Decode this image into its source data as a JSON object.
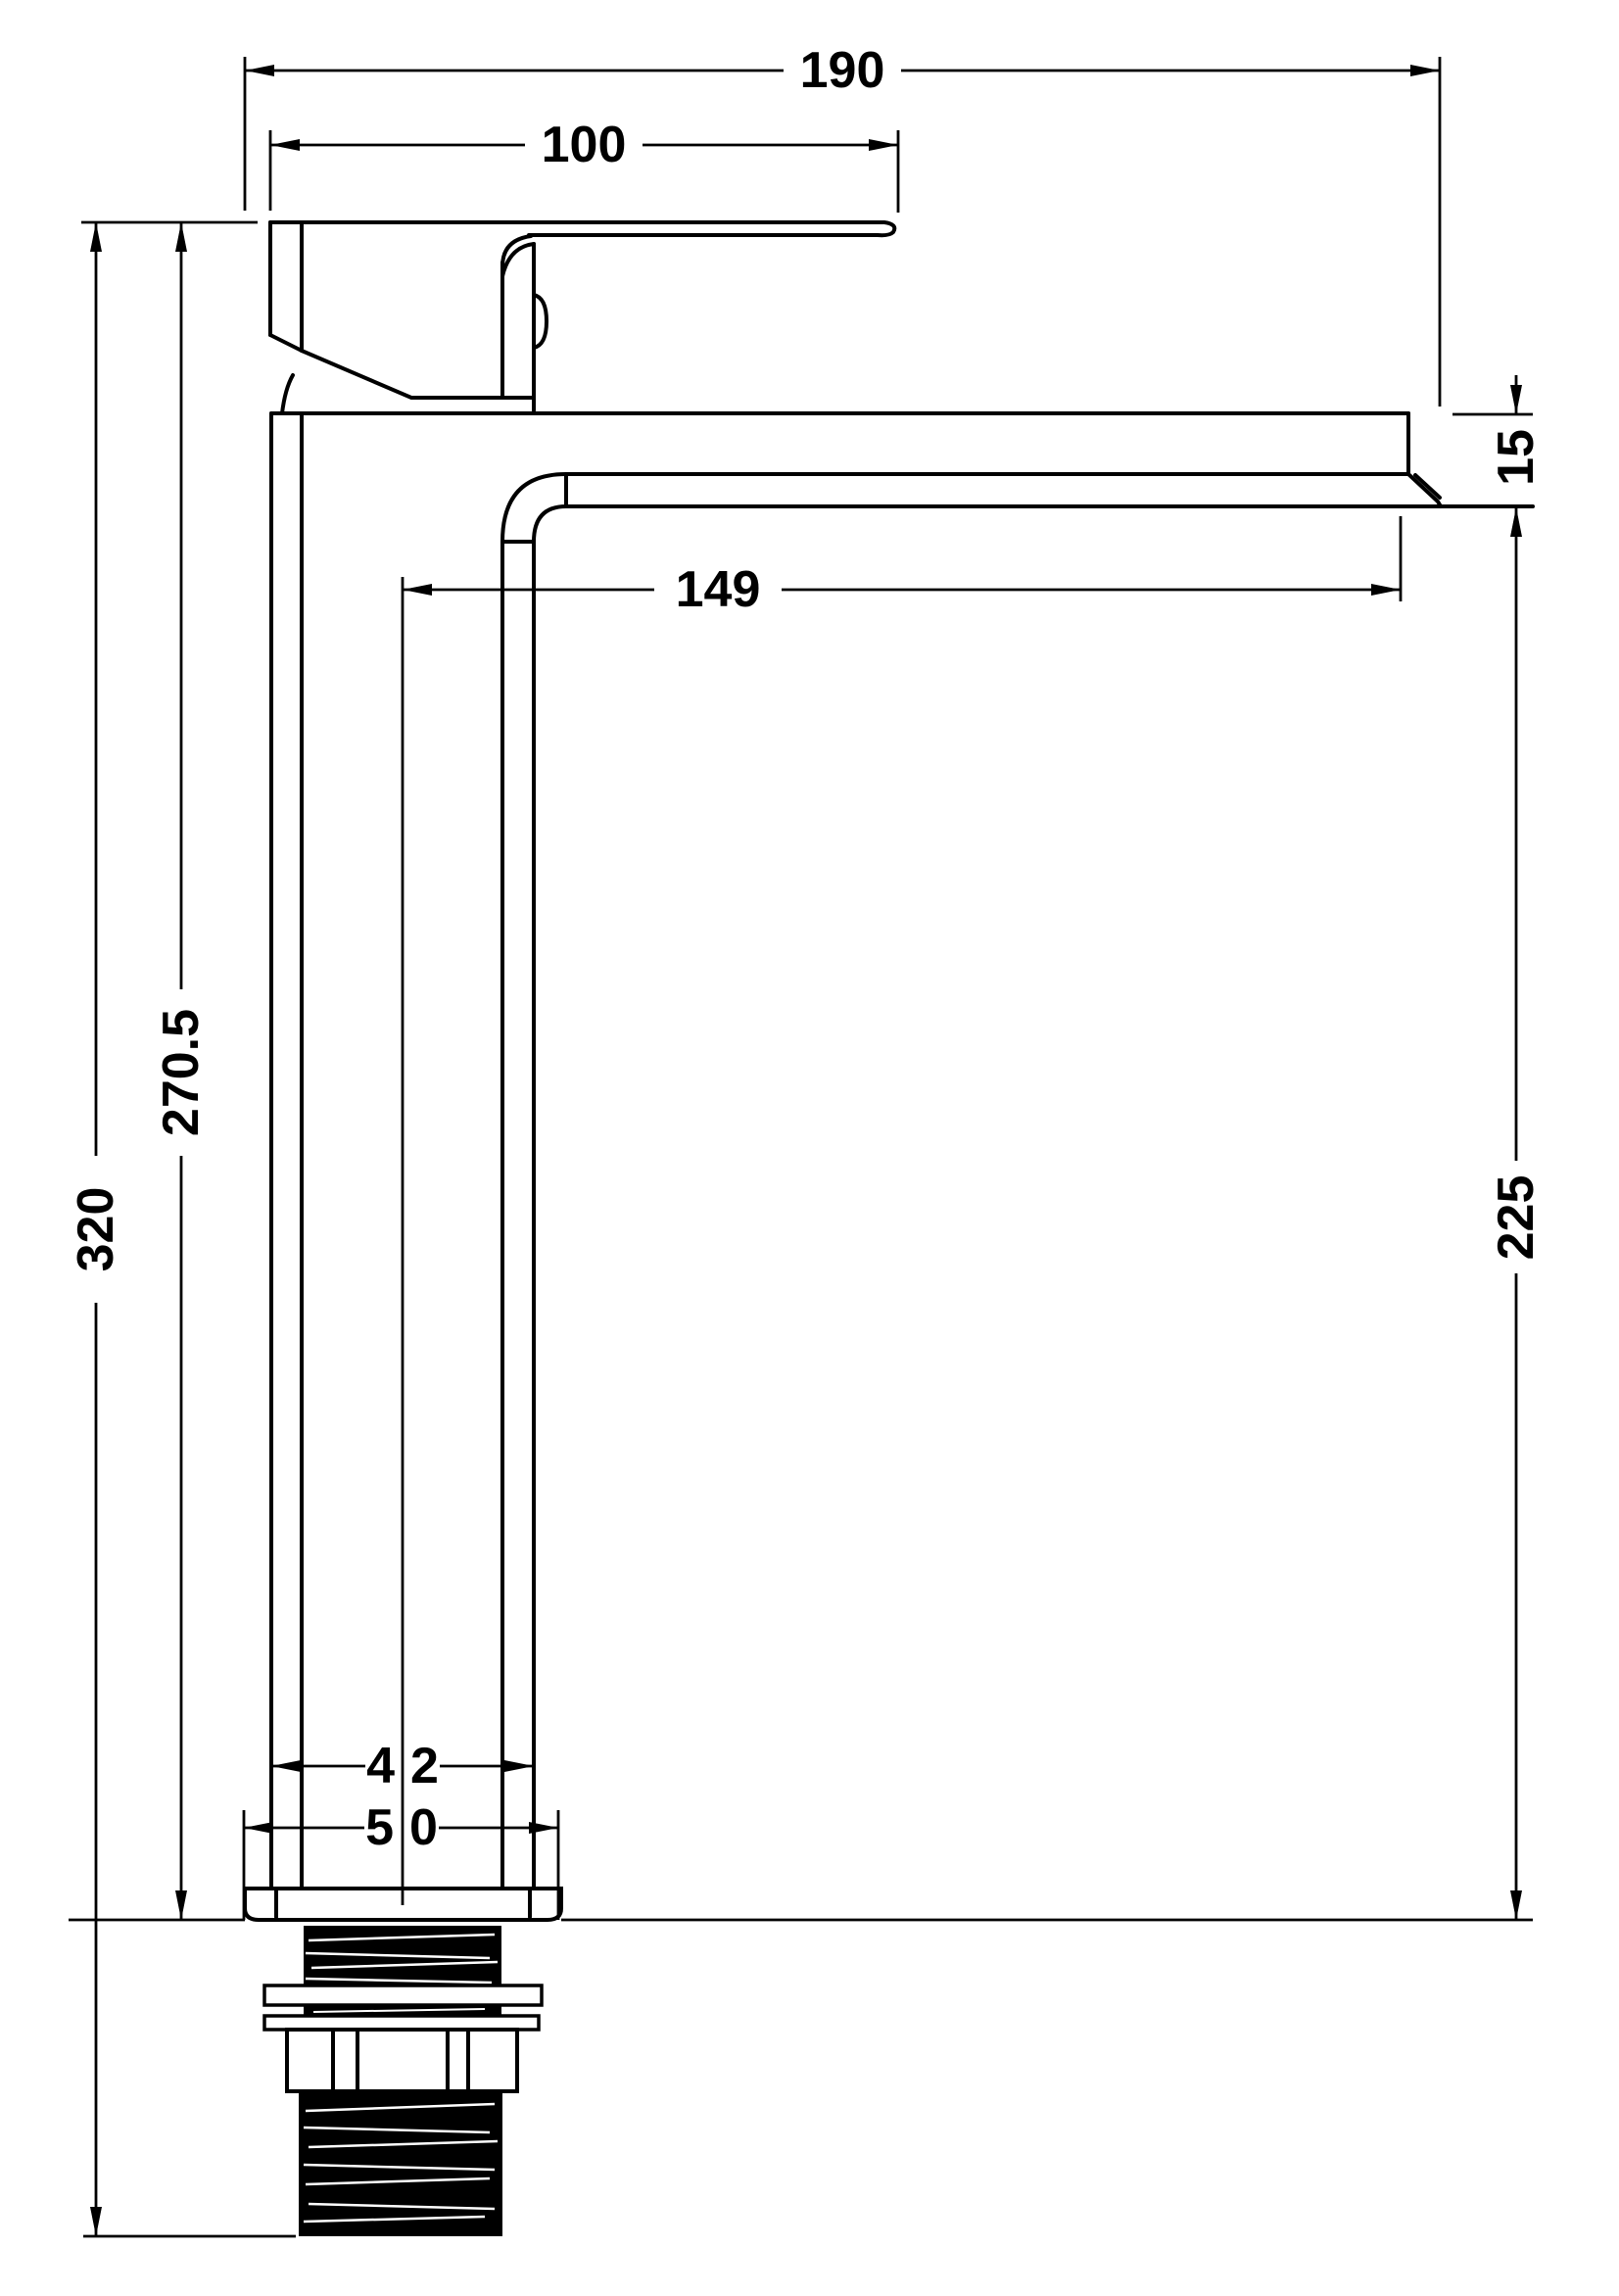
{
  "drawing": {
    "subject": "tall mono basin mixer tap - side elevation technical drawing",
    "background_color": "#ffffff",
    "line_color": "#000000",
    "dimensions_mm": {
      "overall_projection": "190",
      "handle_length": "100",
      "spout_reach": "149",
      "spout_thickness": "15",
      "spout_to_base_height": "225",
      "base_to_handle_height": "270.5",
      "total_height": "320",
      "body_width": "42",
      "base_width": "50"
    }
  }
}
